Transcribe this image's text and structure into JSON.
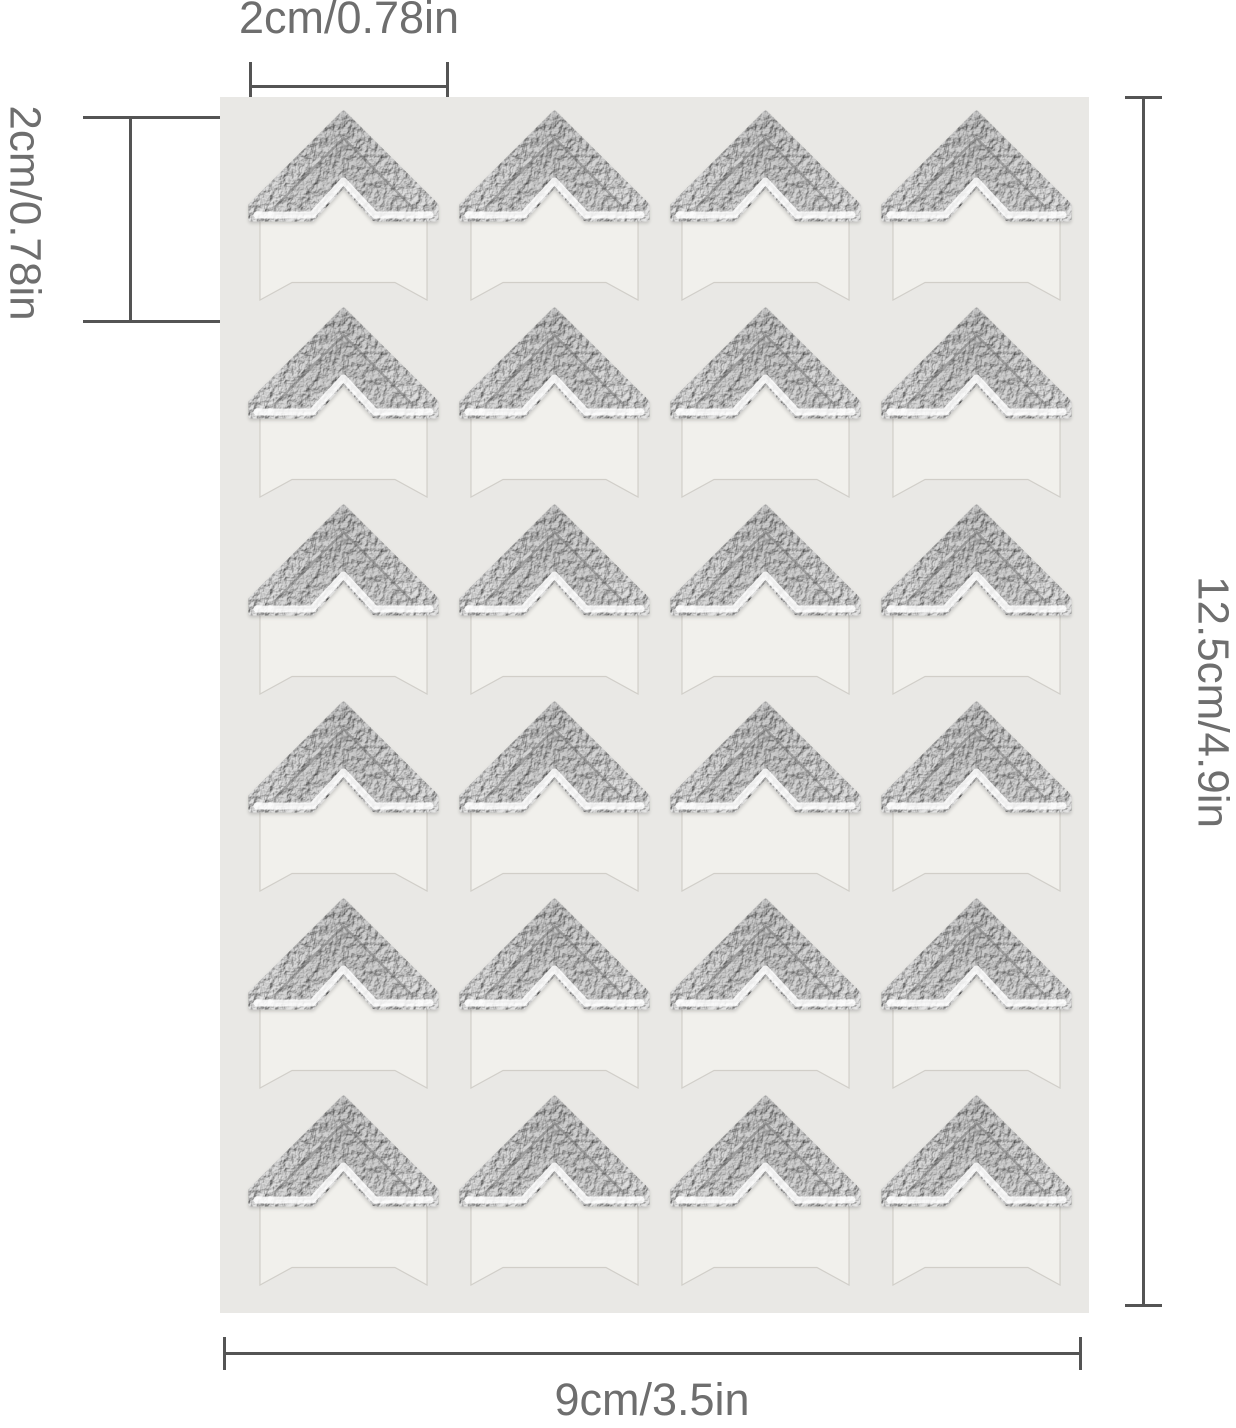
{
  "page": {
    "type": "product-dimension-diagram",
    "subject": "Sheet of self-adhesive metallic photo corner stickers with size annotations",
    "background_color": "#ffffff"
  },
  "sheet": {
    "background_color": "#e9e8e5",
    "grid": {
      "rows": 6,
      "columns": 4,
      "sticker_count": 24
    },
    "sticker": {
      "icon": "photo-corner-chevron-icon",
      "foil_base_color": "#d7d7d7",
      "foil_dark_color": "#c7c7c7",
      "foil_light_color": "#e4e4e4",
      "foil_highlight_color": "#ffffff",
      "backing_flag_color": "#f1f0ec"
    }
  },
  "annotations": {
    "line_color": "#545454",
    "label_color": "#6e6e6e",
    "corner_width": {
      "label": "2cm/0.78in",
      "position": "top"
    },
    "corner_height": {
      "label": "2cm/0.78in",
      "position": "left"
    },
    "sheet_height": {
      "label": "12.5cm/4.9in",
      "position": "right"
    },
    "sheet_width": {
      "label": "9cm/3.5in",
      "position": "bottom"
    }
  }
}
